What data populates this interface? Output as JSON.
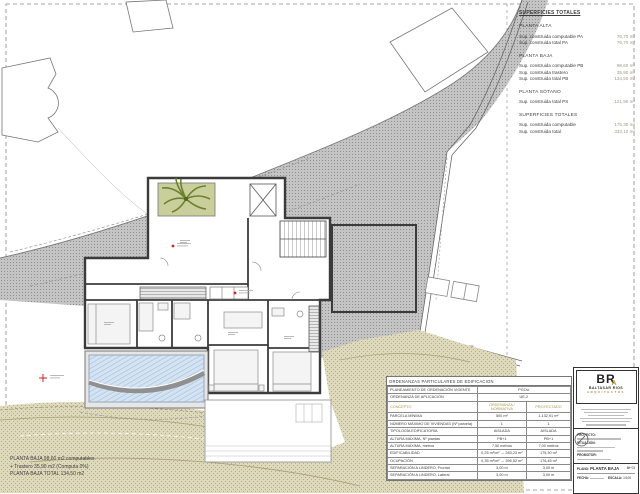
{
  "surfaces_panel": {
    "title": "SUPERFICIES TOTALES",
    "sections": [
      {
        "title": "PLANTA ALTA",
        "rows": [
          {
            "label": "Sup. construida computable PA",
            "value": "76,70 m²"
          },
          {
            "label": "Sup. construida total PA",
            "value": "76,70 m²"
          }
        ]
      },
      {
        "title": "PLANTA BAJA",
        "rows": [
          {
            "label": "Sup. construida computable PB",
            "value": "98,60 m²"
          },
          {
            "label": "Sup. construida trastero",
            "value": "35,90 m²"
          },
          {
            "label": "Sup. construida total PB",
            "value": "134,50 m²"
          }
        ]
      },
      {
        "title": "PLANTA SÓTANO",
        "rows": [
          {
            "label": "Sup. construida total PS",
            "value": "121,90 m²"
          }
        ]
      },
      {
        "title": "SUPERFICIES TOTALES",
        "rows": [
          {
            "label": "Sup. construida computable",
            "value": "175,30 m²"
          },
          {
            "label": "Sup. construida total",
            "value": "333,10 m²"
          }
        ]
      }
    ]
  },
  "notes": {
    "line1": "PLANTA BAJA 98,60 m2 computables",
    "line2": "+ Trastero 35,90 m2 (Computa 0%)",
    "line3": "PLANTA BAJA TOTAL  134,50 m2"
  },
  "ordenanzas": {
    "title": "ORDENANZAS PARTICULARES DE EDIFICACION",
    "planning_rows": [
      {
        "label": "PLANEAMIENTO DE ORDENACIÓN VIGENTE",
        "value": "PGOU"
      },
      {
        "label": "ORDENANZA DE APLICACIÓN",
        "value": "UE-2"
      }
    ],
    "header": {
      "concept": "CONCEPTO",
      "normativa": "ORDENANZA / NORMATIVA",
      "proyectado": "PROYECTADO"
    },
    "rows": [
      {
        "concept": "PARCELA MÍNIMA",
        "normativa": "500 m²",
        "proyectado": "1.132,91 m²"
      },
      {
        "concept": "NÚMERO MÁXIMO DE VIVIENDAS (Nº parcela)",
        "normativa": "1",
        "proyectado": "1"
      },
      {
        "concept": "TIPOLOGÍA EDIFICATORIA",
        "normativa": "AISLADA",
        "proyectado": "AISLADA"
      },
      {
        "concept": "ALTURA MÁXIMA, Nº plantas",
        "normativa": "PB+1",
        "proyectado": "PB+1"
      },
      {
        "concept": "ALTURA MÁXIMA, metros",
        "normativa": "7,50 metros",
        "proyectado": "7,00 metros"
      },
      {
        "concept": "EDIFICABILIDAD",
        "normativa": "0,25 m²/m² → 283,23 m²",
        "proyectado": "175,30 m²"
      },
      {
        "concept": "OCUPACIÓN",
        "normativa": "0,35 m²/m² → 396,52 m²",
        "proyectado": "176,45 m²"
      },
      {
        "concept": "SEPARACIÓN A LINDERO, Frontal",
        "normativa": "3,00 m",
        "proyectado": "3,00 m"
      },
      {
        "concept": "SEPARACIÓN A LINDERO, Lateral",
        "normativa": "3,00 m",
        "proyectado": "3,00 m"
      }
    ]
  },
  "title_block": {
    "logo": {
      "initials": "BR",
      "accent_letter": "A",
      "name": "BALTASAR RIOS",
      "subtitle": "ARQUITECTOS"
    },
    "fields": {
      "project_label": "PROYECTO:",
      "location_label": "SITUACIÓN:",
      "promoter_label": "PROMOTOR:",
      "plan_label": "PLANO:",
      "plan_value": "PLANTA BAJA",
      "plan_number_label": "Nº",
      "plan_number": "03",
      "date_label": "FECHA:",
      "scale_label": "ESCALA:",
      "scale_value": "1/100"
    }
  },
  "colors": {
    "accent_gold": "#c9a437",
    "terrain_gray": "#c2c2c2",
    "khaki": "#ded9ba",
    "pool_blue": "#d4e3f2",
    "courtyard_green": "#c8cf9b",
    "marker_red": "#cc2222",
    "wall_dark": "#3b3b3b"
  }
}
